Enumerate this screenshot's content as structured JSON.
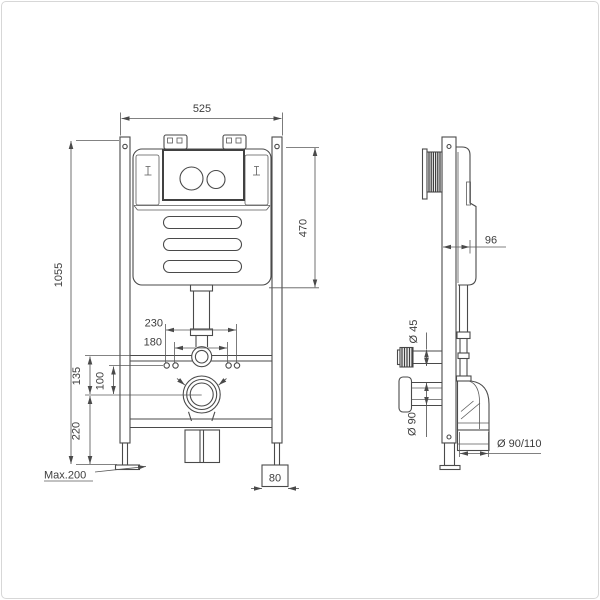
{
  "front_view": {
    "overall_width_label": "525",
    "overall_height_label": "1055",
    "tank_height_label": "470",
    "bolt_spacing_outer_label": "230",
    "bolt_spacing_inner_label": "180",
    "bar_to_outlet_label": "135",
    "bolts_to_outlet_label": "100",
    "outlet_to_base_label": "220",
    "max_foot_adjust_label": "Max.200",
    "foot_plate_width_label": "80"
  },
  "side_view": {
    "frame_depth_label": "96",
    "inlet_diameter_label": "Ø 45",
    "outlet_diameter_label": "Ø 90",
    "waste_pipe_diameter_label": "Ø 90/110"
  },
  "colors": {
    "line": "#4a4a4a",
    "dimension_line": "#575757",
    "text": "#3d3d3d",
    "background": "#ffffff",
    "page_border": "#d7d7d7"
  }
}
